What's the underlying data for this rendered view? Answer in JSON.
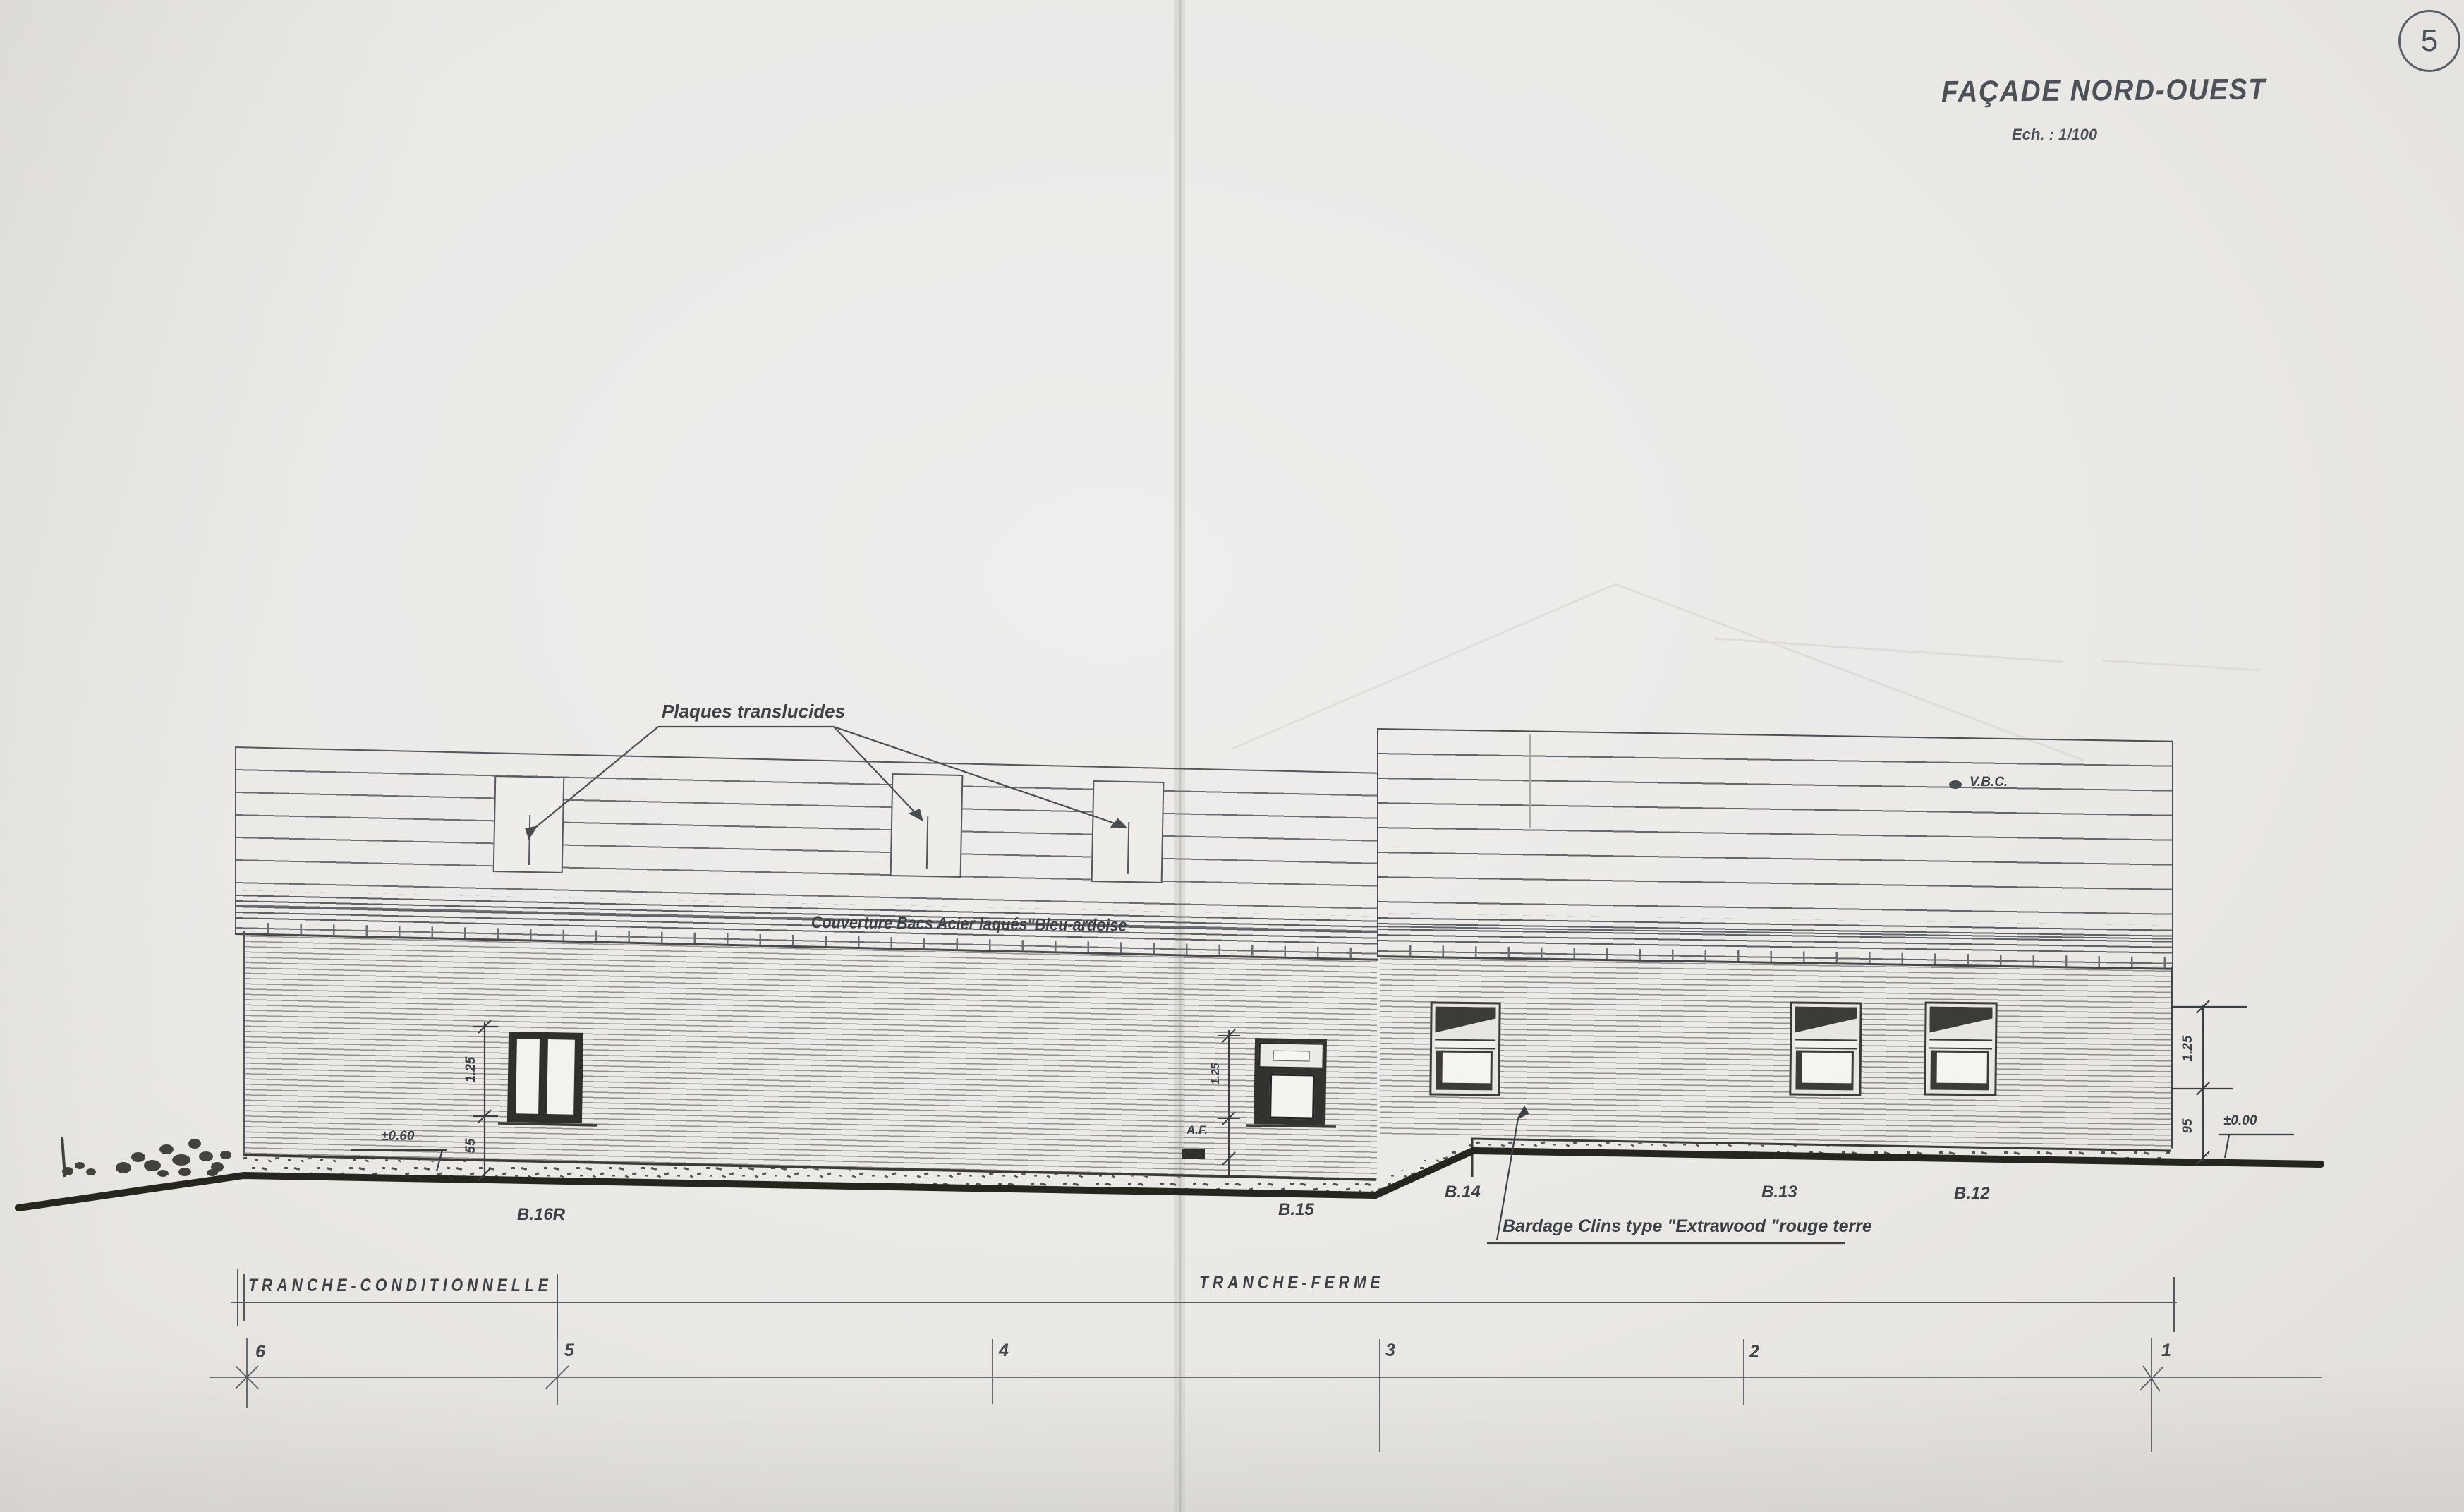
{
  "sheet": {
    "number": "5",
    "paper_color": "#ebe9e6",
    "ink_color": "#4c5158"
  },
  "title": {
    "main": "FAÇADE NORD-OUEST",
    "scale": "Ech. : 1/100"
  },
  "annotations": {
    "plaques": "Plaques translucides",
    "couverture": "Couverture Bacs Acier laqués\"Bleu-ardoise",
    "vbc": "V.B.C.",
    "af": "A.F.",
    "bardage": "Bardage Clins type \"Extrawood \"rouge terre"
  },
  "dimensions": {
    "b16_height": "1.25",
    "b16_base": "55",
    "left_level": "±0.60",
    "b15_height": "1.25",
    "right_height": "1.25",
    "right_base": "95",
    "right_level": "±0.00"
  },
  "windows": {
    "labels": [
      "B.16R",
      "B.15",
      "B.14",
      "B.13",
      "B.12"
    ]
  },
  "phases": {
    "conditionnelle": "TRANCHE-CONDITIONNELLE",
    "ferme": "TRANCHE-FERME"
  },
  "grid": {
    "numbers": [
      "6",
      "5",
      "4",
      "3",
      "2",
      "1"
    ]
  }
}
